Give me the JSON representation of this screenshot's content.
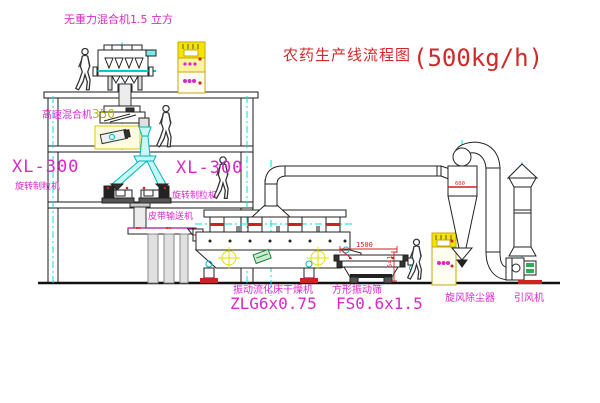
{
  "title": {
    "text": "农药生产线流程图",
    "capacity": "(500kg/h)"
  },
  "labels": {
    "gravity_mixer": "无重力混合机1.5 立方",
    "high_speed_mixer_name": "高速混合机",
    "high_speed_mixer_model": "350",
    "granulator_left_model": "XL-300",
    "granulator_left_name": "旋转制粒机",
    "granulator_right_model": "XL-300",
    "granulator_right_name": "旋转制粒机",
    "belt_conveyor": "皮带输送机",
    "dryer_name": "振动流化床干燥机",
    "dryer_model": "ZLG6x0.75",
    "screen_name": "方形振动筛",
    "screen_model": "FS0.6x1.5",
    "cyclone": "旋风除尘器",
    "fan": "引风机"
  },
  "dimensions": {
    "screen_length": "1500",
    "screen_height": "541",
    "cyclone_diameter": "600"
  },
  "colors": {
    "label_magenta": "#d928c8",
    "title_red": "#cf2a2a",
    "centerline_cyan": "#00e0e0",
    "cabinet_yellow": "#f5e400",
    "dimension_red": "#cc2222"
  }
}
